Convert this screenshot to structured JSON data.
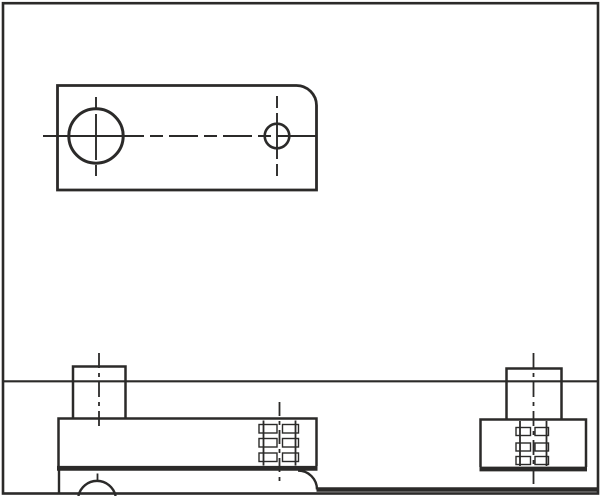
{
  "meta": {
    "title": "Two-view technical line drawing of a stop plate with studs and threaded holes",
    "views": [
      "top view (plan) with rounded corner and two holes",
      "front elevation with studs, thread symbols and mounting surface"
    ],
    "text_content": "none (drawing contains no visible text, dimensions or labels)"
  },
  "canvas": {
    "width": 601,
    "height": 496,
    "background": "#ffffff",
    "stroke_color": "#2b2a29",
    "thread_dash_fill": "#ffffff"
  },
  "drawing": {
    "elements": [
      {
        "name": "border-frame",
        "type": "rect",
        "x": 3,
        "y": 3.2,
        "w": 595,
        "h": 490.3,
        "sw": 2.6
      },
      {
        "name": "top-view-plate-outline",
        "type": "path",
        "d": "M 57.5,190 L 57.5,85.5 L 296.5,85.5 A 20,20 0 0 1 316.5,105.5 L 316.5,190 Z",
        "sw": 2.8
      },
      {
        "name": "large-hole-circle",
        "type": "circle",
        "cx": 96,
        "cy": 136,
        "r": 27.2,
        "sw": 3
      },
      {
        "name": "small-hole-circle",
        "type": "circle",
        "cx": 277,
        "cy": 136,
        "r": 12.3,
        "sw": 2.6
      },
      {
        "name": "horizontal-centerline",
        "type": "line",
        "x1": 43,
        "y1": 136,
        "x2": 331,
        "y2": 136,
        "sw": 1.9,
        "dash": "101 6 13 6 29 6 13 6 29 6 13 6 40"
      },
      {
        "name": "large-hole-centerline",
        "type": "line",
        "x1": 96,
        "y1": 97,
        "x2": 96,
        "y2": 176,
        "sw": 1.9,
        "dash": "12 5 46 5 11"
      },
      {
        "name": "small-hole-centerline",
        "type": "line",
        "x1": 277,
        "y1": 96,
        "x2": 277,
        "y2": 176,
        "sw": 1.9,
        "dash": "12 5 46 5 12"
      },
      {
        "name": "table-line",
        "type": "line",
        "x1": 3,
        "y1": 381.3,
        "x2": 598,
        "y2": 381.3,
        "sw": 2.2
      },
      {
        "name": "left-stud-outline",
        "type": "path",
        "d": "M 73,418 V 366.5 H 125.5 V 418",
        "sw": 2.5
      },
      {
        "name": "plate-front-outline",
        "type": "path",
        "d": "M 58.5,466 V 418.5 H 316.5 V 466",
        "sw": 2.5
      },
      {
        "name": "plate-front-bottom-edge",
        "type": "line",
        "x1": 57,
        "y1": 468.3,
        "x2": 317.5,
        "y2": 468.3,
        "sw": 4.8
      },
      {
        "name": "fillet-arc",
        "type": "path",
        "d": "M 298,470.5 A 19,19 0 0 1 317,489.5",
        "sw": 2.4
      },
      {
        "name": "table-edge-line",
        "type": "line",
        "x1": 316.5,
        "y1": 489.5,
        "x2": 598,
        "y2": 489.5,
        "sw": 4.6
      },
      {
        "name": "base-left-edge",
        "type": "line",
        "x1": 59,
        "y1": 470.5,
        "x2": 59,
        "y2": 494,
        "sw": 2.4
      },
      {
        "name": "screw-head-arc",
        "type": "path",
        "d": "M 78.4,496 A 19,19 0 0 1 115.6,496",
        "sw": 2.4
      },
      {
        "name": "left-stud-centerline",
        "type": "line",
        "x1": 99,
        "y1": 353,
        "x2": 99,
        "y2": 430.5,
        "sw": 1.8,
        "dash": "15 5 4 5"
      },
      {
        "name": "left-stud-centerline-tail",
        "type": "line",
        "x1": 97.5,
        "y1": 473.5,
        "x2": 97.5,
        "y2": 480.5,
        "sw": 1.8
      },
      {
        "name": "thread-dash-mid-1",
        "type": "rect",
        "x": 259,
        "y": 424.5,
        "w": 18,
        "h": 8.5,
        "sw": 1.4,
        "fill": "#ffffff"
      },
      {
        "name": "thread-dash-mid-2",
        "type": "rect",
        "x": 282.5,
        "y": 424.5,
        "w": 16,
        "h": 8.5,
        "sw": 1.4,
        "fill": "#ffffff"
      },
      {
        "name": "thread-dash-mid-3",
        "type": "rect",
        "x": 259,
        "y": 438.5,
        "w": 18,
        "h": 8.5,
        "sw": 1.4,
        "fill": "#ffffff"
      },
      {
        "name": "thread-dash-mid-4",
        "type": "rect",
        "x": 282.5,
        "y": 438.5,
        "w": 16,
        "h": 8.5,
        "sw": 1.4,
        "fill": "#ffffff"
      },
      {
        "name": "thread-dash-mid-5",
        "type": "rect",
        "x": 259,
        "y": 453,
        "w": 18,
        "h": 8.5,
        "sw": 1.4,
        "fill": "#ffffff"
      },
      {
        "name": "thread-dash-mid-6",
        "type": "rect",
        "x": 282.5,
        "y": 453,
        "w": 16,
        "h": 8.5,
        "sw": 1.4,
        "fill": "#ffffff"
      },
      {
        "name": "mid-thread-bore-left",
        "type": "line",
        "x1": 263.5,
        "y1": 420.5,
        "x2": 263.5,
        "y2": 465.5,
        "sw": 1.8
      },
      {
        "name": "mid-thread-bore-right",
        "type": "line",
        "x1": 295.5,
        "y1": 420.5,
        "x2": 295.5,
        "y2": 465.5,
        "sw": 1.8
      },
      {
        "name": "mid-hole-centerline",
        "type": "line",
        "x1": 279.5,
        "y1": 402,
        "x2": 279.5,
        "y2": 484,
        "sw": 1.8,
        "dash": "14 5 4 5"
      },
      {
        "name": "right-stud-outline",
        "type": "path",
        "d": "M 506.5,419 V 368.5 H 561.5 V 419",
        "sw": 2.5
      },
      {
        "name": "right-block-outline",
        "type": "path",
        "d": "M 480.5,467 V 419.5 H 586 V 467",
        "sw": 2.5
      },
      {
        "name": "right-block-bottom-edge",
        "type": "line",
        "x1": 479.5,
        "y1": 469,
        "x2": 587,
        "y2": 469,
        "sw": 4.8
      },
      {
        "name": "thread-dash-right-1",
        "type": "rect",
        "x": 516,
        "y": 427.5,
        "w": 14.5,
        "h": 8,
        "sw": 1.4,
        "fill": "#ffffff"
      },
      {
        "name": "thread-dash-right-2",
        "type": "rect",
        "x": 535,
        "y": 427.5,
        "w": 13.5,
        "h": 8,
        "sw": 1.4,
        "fill": "#ffffff"
      },
      {
        "name": "thread-dash-right-3",
        "type": "rect",
        "x": 516,
        "y": 443,
        "w": 14.5,
        "h": 8,
        "sw": 1.4,
        "fill": "#ffffff"
      },
      {
        "name": "thread-dash-right-4",
        "type": "rect",
        "x": 535,
        "y": 443,
        "w": 13.5,
        "h": 8,
        "sw": 1.4,
        "fill": "#ffffff"
      },
      {
        "name": "thread-dash-right-5",
        "type": "rect",
        "x": 516,
        "y": 456.5,
        "w": 14.5,
        "h": 8,
        "sw": 1.4,
        "fill": "#ffffff"
      },
      {
        "name": "thread-dash-right-6",
        "type": "rect",
        "x": 535,
        "y": 456.5,
        "w": 13.5,
        "h": 8,
        "sw": 1.4,
        "fill": "#ffffff"
      },
      {
        "name": "right-thread-bore-left",
        "type": "line",
        "x1": 520,
        "y1": 421,
        "x2": 520,
        "y2": 466,
        "sw": 1.8
      },
      {
        "name": "right-thread-bore-right",
        "type": "line",
        "x1": 546.5,
        "y1": 421,
        "x2": 546.5,
        "y2": 466,
        "sw": 1.8
      },
      {
        "name": "right-stud-centerline",
        "type": "line",
        "x1": 533.5,
        "y1": 353,
        "x2": 533.5,
        "y2": 484,
        "sw": 1.8,
        "dash": "15 5 4 5"
      }
    ]
  }
}
